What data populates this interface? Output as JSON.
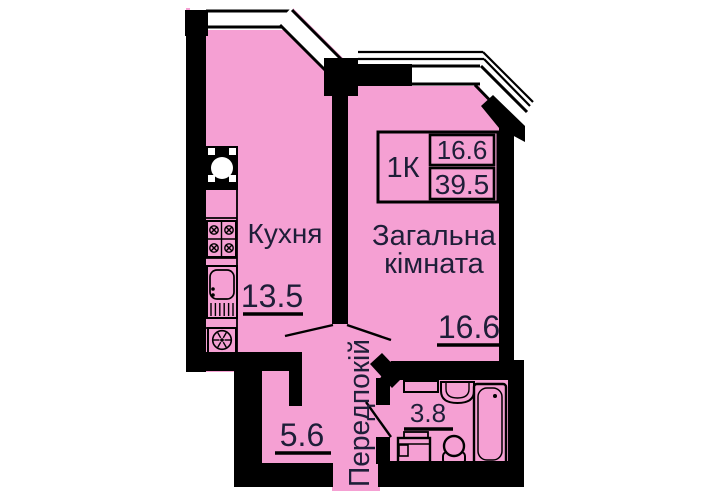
{
  "plan": {
    "kind": "apartment-floor-plan",
    "info_box": {
      "type": "1К",
      "living_area": "16.6",
      "total_area": "39.5"
    },
    "rooms": {
      "kitchen": {
        "name": "Кухня",
        "area": "13.5"
      },
      "living": {
        "name_line1": "Загальна",
        "name_line2": "кімната",
        "area": "16.6"
      },
      "hall": {
        "name": "Передпокій",
        "area": "5.6"
      },
      "bathroom": {
        "area": "3.8"
      }
    },
    "colors": {
      "floor": "#F5A0D3",
      "wall": "#000000",
      "text": "#1E1E38",
      "background": "#FFFFFF"
    },
    "fixtures": [
      "vent-icon",
      "stove-icon",
      "kitchen-sink-icon",
      "fan-icon",
      "shelf-icon",
      "washbasin-icon",
      "bathtub-icon",
      "washing-machine-icon",
      "toilet-icon"
    ]
  }
}
